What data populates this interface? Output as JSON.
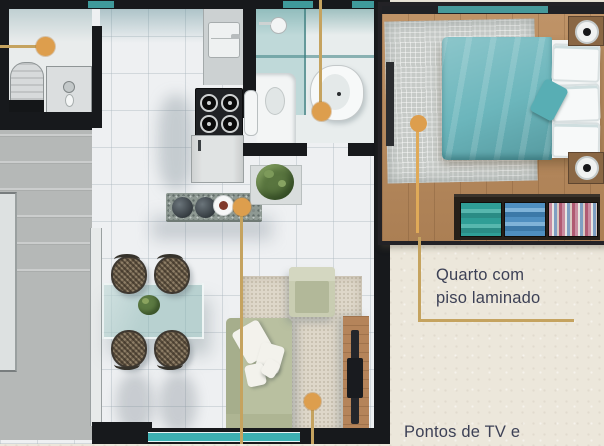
{
  "image_type": "apartment floor plan render with bedroom detail inset",
  "labels": {
    "bedroom": {
      "line1": "Quarto com",
      "line2": "piso laminado"
    },
    "bottom": "Pontos de TV e"
  },
  "callouts": [
    {
      "id": "laundry-point"
    },
    {
      "id": "bathroom-point"
    },
    {
      "id": "kitchen-counter-point"
    },
    {
      "id": "living-room-point"
    },
    {
      "id": "bedroom-floor-point",
      "label": "Quarto com piso laminado"
    },
    {
      "id": "tv-points",
      "label": "Pontos de TV e"
    }
  ],
  "colors": {
    "paper_cream": "#ece7db",
    "callout_line_gold": "#c5a35f",
    "callout_dot_orange": "#dd9e4d",
    "caption_text_navy": "#3d4156",
    "wall_black": "#17191c",
    "window_teal": "#3f9a9b",
    "duvet_teal": "#6cb6bc",
    "sofa_sage": "#b9c0a0",
    "wood_floor": "#b98c62",
    "exterior_gray": "#b5b8b7"
  }
}
